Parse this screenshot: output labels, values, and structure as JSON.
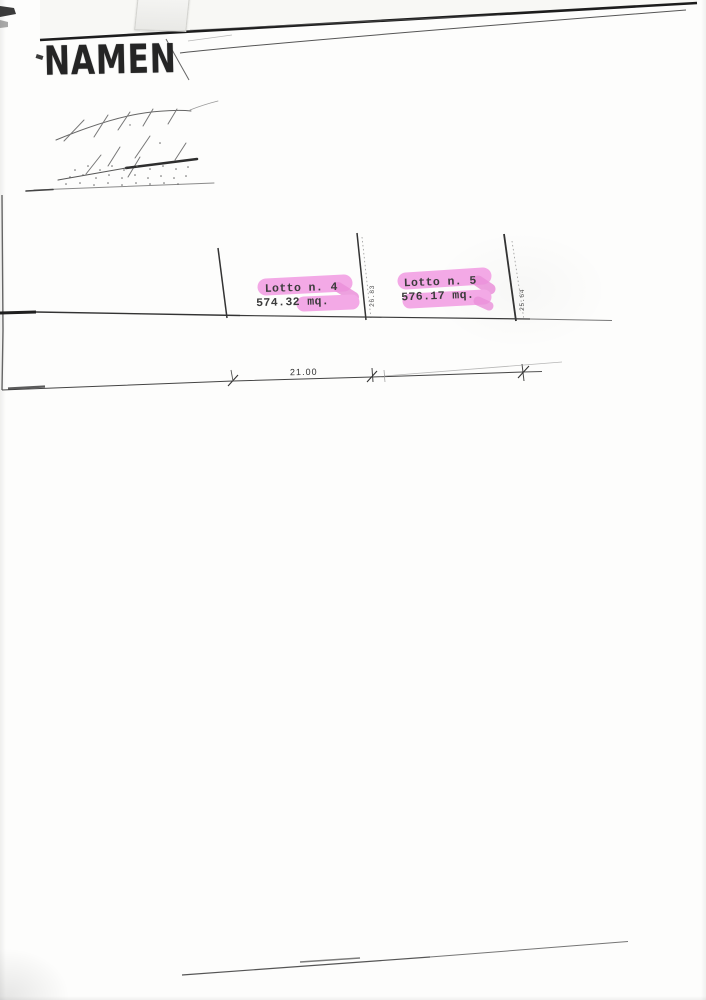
{
  "page": {
    "stamp": {
      "text": "NAMEN"
    },
    "plan": {
      "lots": [
        {
          "id": "lot-4",
          "name": "Lotto n. 4",
          "area": "574.32 mq."
        },
        {
          "id": "lot-5",
          "name": "Lotto n. 5",
          "area": "576.17 mq."
        }
      ],
      "boundary_dimensions": [
        {
          "id": "dim-center-boundary",
          "value": "26.83"
        },
        {
          "id": "dim-right-boundary",
          "value": "25.64"
        }
      ],
      "width_dimension": {
        "value": "21.00"
      }
    },
    "colors": {
      "highlight_pink": "#f3a9e6",
      "highlight_pink_dark": "#ea90d9",
      "ink": "#2b2b2b"
    }
  }
}
